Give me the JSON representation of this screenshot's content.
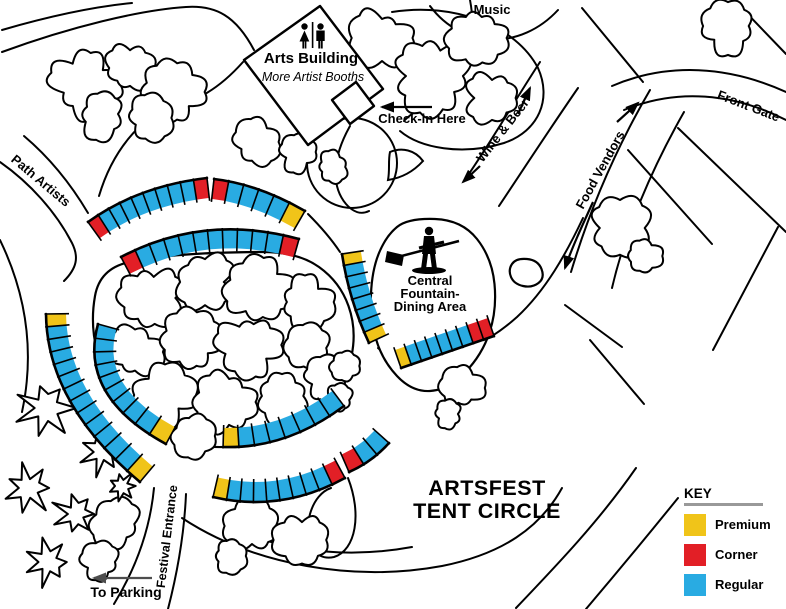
{
  "title": {
    "line1": "ARTSFEST",
    "line2": "TENT CIRCLE"
  },
  "key": {
    "heading": "KEY",
    "items": [
      {
        "label": "Premium",
        "type": "premium",
        "color": "#F0C419"
      },
      {
        "label": "Corner",
        "type": "corner",
        "color": "#E21F26"
      },
      {
        "label": "Regular",
        "type": "regular",
        "color": "#29ABE2"
      }
    ]
  },
  "palette": {
    "ink": "#000000",
    "gray_arrow": "#4d4d4d",
    "key_underline": "#999999",
    "premium": "#F0C419",
    "corner": "#E21F26",
    "regular": "#29ABE2"
  },
  "labels": [
    {
      "id": "music",
      "text": "Music",
      "x": 492,
      "y": 14,
      "rot": 0,
      "size": 13
    },
    {
      "id": "arts-building",
      "text": "Arts Building",
      "x": 311,
      "y": 63,
      "rot": 0,
      "size": 15
    },
    {
      "id": "arts-building-sub",
      "text": "More Artist Booths",
      "x": 313,
      "y": 81,
      "rot": 0,
      "size": 12.5,
      "italic": true,
      "weight": "normal"
    },
    {
      "id": "checkin",
      "text": "Check-in Here",
      "x": 422,
      "y": 123,
      "rot": 0,
      "size": 13
    },
    {
      "id": "wine-beer",
      "text": "Wine & Beer",
      "x": 506,
      "y": 133,
      "rot": -52,
      "size": 13
    },
    {
      "id": "food-vendors",
      "text": "Food Vendors",
      "x": 604,
      "y": 172,
      "rot": -61,
      "size": 13
    },
    {
      "id": "front-gate",
      "text": "Front Gate",
      "x": 747,
      "y": 110,
      "rot": 21,
      "size": 13
    },
    {
      "id": "path-artists",
      "text": "Path Artists",
      "x": 38,
      "y": 184,
      "rot": 40,
      "size": 13
    },
    {
      "id": "fountain-line1",
      "text": "Central",
      "x": 430,
      "y": 285,
      "rot": 0,
      "size": 13
    },
    {
      "id": "fountain-line2",
      "text": "Fountain-",
      "x": 430,
      "y": 298,
      "rot": 0,
      "size": 13
    },
    {
      "id": "fountain-line3",
      "text": "Dining Area",
      "x": 430,
      "y": 311,
      "rot": 0,
      "size": 13
    },
    {
      "id": "festival-entrance",
      "text": "Festival Entrance",
      "x": 171,
      "y": 537,
      "rot": -83,
      "size": 12.5
    },
    {
      "id": "to-parking",
      "text": "To Parking",
      "x": 126,
      "y": 597,
      "rot": 0,
      "size": 14
    }
  ],
  "map_data": {
    "tent_color_codes": {
      "Y": "premium",
      "R": "corner",
      "B": "regular"
    },
    "tent_segments": [
      {
        "name": "outer-top-left",
        "p0": [
          88,
          222
        ],
        "p1": [
          138,
          186
        ],
        "p2": [
          207,
          178
        ],
        "width": 20,
        "side": 1,
        "colors": [
          "R",
          "B",
          "B",
          "B",
          "B",
          "B",
          "B",
          "B",
          "B",
          "R"
        ]
      },
      {
        "name": "outer-top-right",
        "p0": [
          214,
          179
        ],
        "p1": [
          258,
          184
        ],
        "p2": [
          305,
          211
        ],
        "width": 20,
        "side": 1,
        "colors": [
          "R",
          "B",
          "B",
          "B",
          "B",
          "Y"
        ]
      },
      {
        "name": "inner-top",
        "p0": [
          121,
          257
        ],
        "p1": [
          205,
          213
        ],
        "p2": [
          299,
          239
        ],
        "width": 19,
        "side": 1,
        "colors": [
          "R",
          "B",
          "B",
          "B",
          "B",
          "B",
          "B",
          "B",
          "B",
          "B",
          "B",
          "R"
        ]
      },
      {
        "name": "east-strip",
        "p0": [
          342,
          254
        ],
        "p1": [
          349,
          300
        ],
        "p2": [
          369,
          343
        ],
        "width": 19,
        "side": -1,
        "colors": [
          "Y",
          "B",
          "B",
          "B",
          "B",
          "B",
          "B",
          "Y"
        ]
      },
      {
        "name": "fountain-south",
        "p0": [
          401,
          368
        ],
        "p1": [
          447,
          352
        ],
        "p2": [
          494,
          336
        ],
        "width": 19,
        "side": -1,
        "colors": [
          "Y",
          "B",
          "B",
          "B",
          "B",
          "B",
          "B",
          "R",
          "R"
        ]
      },
      {
        "name": "outer-left",
        "p0": [
          46,
          314
        ],
        "p1": [
          47,
          404
        ],
        "p2": [
          140,
          482
        ],
        "width": 20,
        "side": -1,
        "colors": [
          "Y",
          "B",
          "B",
          "B",
          "B",
          "B",
          "B",
          "B",
          "B",
          "B",
          "B",
          "B",
          "B",
          "Y"
        ]
      },
      {
        "name": "inner-left",
        "p0": [
          98,
          324
        ],
        "p1": [
          78,
          396
        ],
        "p2": [
          166,
          444
        ],
        "width": 19,
        "side": -1,
        "colors": [
          "B",
          "B",
          "B",
          "B",
          "B",
          "B",
          "B",
          "B",
          "B",
          "Y"
        ]
      },
      {
        "name": "inner-bottom",
        "p0": [
          223,
          447
        ],
        "p1": [
          287,
          449
        ],
        "p2": [
          344,
          406
        ],
        "width": 19,
        "side": -1,
        "colors": [
          "Y",
          "B",
          "B",
          "B",
          "B",
          "B",
          "B",
          "B"
        ]
      },
      {
        "name": "outer-bottom",
        "p0": [
          213,
          497
        ],
        "p1": [
          281,
          513
        ],
        "p2": [
          345,
          478
        ],
        "width": 20,
        "side": -1,
        "colors": [
          "Y",
          "B",
          "B",
          "B",
          "B",
          "B",
          "B",
          "B",
          "B",
          "R"
        ]
      },
      {
        "name": "outer-southeast",
        "p0": [
          349,
          472
        ],
        "p1": [
          372,
          462
        ],
        "p2": [
          389,
          443
        ],
        "width": 19,
        "side": -1,
        "colors": [
          "R",
          "B",
          "B"
        ]
      }
    ],
    "roads": [
      {
        "name": "road-top-left-upper",
        "d": "M 2,30 C 50,16 92,7 132,3"
      },
      {
        "name": "road-top-left-lower",
        "d": "M 2,52 C 70,27 140,10 186,7 C 216,5 236,16 254,50"
      },
      {
        "name": "road-path-artists-left",
        "d": "M 0,162 C 30,183 56,212 72,243 C 79,257 77,268 64,281"
      },
      {
        "name": "road-path-artists-right",
        "d": "M 24,136 C 50,158 72,186 88,213"
      },
      {
        "name": "road-building-southwest",
        "d": "M 243,62 C 218,90 196,101 172,107 C 140,117 112,152 99,196"
      },
      {
        "name": "road-checkin-south",
        "d": "M 350,126 C 332,158 331,186 346,204 C 353,212 361,215 369,211"
      },
      {
        "name": "road-northeast-loop",
        "d": "M 392,12 C 455,2 516,26 538,68 C 552,99 539,131 504,143 C 462,156 420,148 400,131"
      },
      {
        "name": "road-building-east",
        "d": "M 470,0 C 478,42 465,78 437,98 C 426,106 412,112 404,121"
      },
      {
        "name": "road-island",
        "d": "M 390,152 C 402,147 415,150 423,161 C 413,172 401,178 388,180 C 390,170 388,161 390,152 Z"
      },
      {
        "name": "road-west-bush-loop",
        "d": "M 397,163 A 45 45 0 1 0 307,163 A 45 45 0 1 0 397,163"
      },
      {
        "name": "road-music-arc",
        "d": "M 430,6 C 463,50 521,50 558,10"
      },
      {
        "name": "road-wine-beer-left",
        "d": "M 540,62 C 512,105 488,147 464,181"
      },
      {
        "name": "road-wine-beer-right",
        "d": "M 578,88 C 549,130 523,170 499,206"
      },
      {
        "name": "road-food-vendors-left",
        "d": "M 650,90 C 615,150 589,212 571,272"
      },
      {
        "name": "road-food-vendors-right",
        "d": "M 684,112 C 651,170 625,232 612,288"
      },
      {
        "name": "road-food-curve-south",
        "d": "M 583,218 C 566,254 546,290 517,317 C 508,325 500,331 492,336"
      },
      {
        "name": "road-front-gate-upper",
        "d": "M 612,86 C 668,62 729,66 786,92"
      },
      {
        "name": "road-front-gate-lower",
        "d": "M 624,110 C 677,88 733,93 786,120"
      },
      {
        "name": "road-ring-northeast",
        "d": "M 308,214 C 322,228 332,240 340,252"
      },
      {
        "name": "road-ring-east",
        "d": "M 378,348 C 388,357 395,362 400,367"
      },
      {
        "name": "road-diagonal-1",
        "d": "M 582,8 L 643,82"
      },
      {
        "name": "road-diagonal-2",
        "d": "M 628,150 L 712,244"
      },
      {
        "name": "road-diagonal-3",
        "d": "M 678,128 L 786,232"
      },
      {
        "name": "road-diagonal-4",
        "d": "M 778,227 L 713,350"
      },
      {
        "name": "road-diagonal-5",
        "d": "M 590,340 L 644,404"
      },
      {
        "name": "road-diagonal-6",
        "d": "M 736,2 L 786,54"
      },
      {
        "name": "road-diagonal-7",
        "d": "M 565,305 L 622,347"
      },
      {
        "name": "road-southeast-upper",
        "d": "M 636,468 C 600,520 558,564 516,608"
      },
      {
        "name": "road-southeast-lower",
        "d": "M 678,498 C 644,540 614,576 586,609"
      },
      {
        "name": "road-bottom-outer",
        "d": "M 182,518 C 255,566 355,582 442,566 C 502,554 540,528 562,488"
      },
      {
        "name": "road-bottom-inner",
        "d": "M 230,528 C 290,553 352,558 412,547"
      },
      {
        "name": "road-festival-left",
        "d": "M 154,488 C 150,530 136,568 114,604"
      },
      {
        "name": "road-festival-right",
        "d": "M 186,494 C 184,540 176,578 168,609"
      },
      {
        "name": "road-left-edge",
        "d": "M 0,240 C 28,298 34,356 22,412"
      },
      {
        "name": "road-se-loop",
        "d": "M 348,478 C 362,514 356,550 334,557 C 313,562 303,538 310,514 C 314,500 322,491 331,488"
      }
    ],
    "white_areas": [
      {
        "name": "central-lawn",
        "points": [
          [
            100,
            268
          ],
          [
            160,
            256
          ],
          [
            228,
            252
          ],
          [
            298,
            252
          ],
          [
            340,
            282
          ],
          [
            357,
            330
          ],
          [
            346,
            382
          ],
          [
            310,
            422
          ],
          [
            254,
            446
          ],
          [
            194,
            448
          ],
          [
            140,
            424
          ],
          [
            104,
            378
          ],
          [
            90,
            324
          ]
        ]
      },
      {
        "name": "fountain-dining-area",
        "points": [
          [
            408,
            218
          ],
          [
            462,
            220
          ],
          [
            492,
            258
          ],
          [
            497,
            310
          ],
          [
            482,
            355
          ],
          [
            448,
            390
          ],
          [
            412,
            392
          ],
          [
            382,
            360
          ],
          [
            370,
            318
          ],
          [
            372,
            270
          ],
          [
            386,
            236
          ]
        ]
      },
      {
        "name": "small-pond",
        "points": [
          [
            516,
            258
          ],
          [
            538,
            260
          ],
          [
            545,
            278
          ],
          [
            532,
            288
          ],
          [
            514,
            284
          ],
          [
            508,
            270
          ]
        ]
      }
    ],
    "bushes": [
      [
        85,
        85,
        30
      ],
      [
        130,
        68,
        24
      ],
      [
        172,
        92,
        28
      ],
      [
        102,
        114,
        22
      ],
      [
        150,
        118,
        20
      ],
      [
        382,
        38,
        26
      ],
      [
        432,
        76,
        32
      ],
      [
        478,
        38,
        28
      ],
      [
        492,
        98,
        24
      ],
      [
        256,
        142,
        20
      ],
      [
        298,
        152,
        18
      ],
      [
        332,
        167,
        15
      ],
      [
        150,
        298,
        28
      ],
      [
        205,
        282,
        26
      ],
      [
        258,
        290,
        30
      ],
      [
        305,
        302,
        24
      ],
      [
        135,
        352,
        24
      ],
      [
        192,
        340,
        28
      ],
      [
        250,
        345,
        28
      ],
      [
        308,
        348,
        22
      ],
      [
        165,
        395,
        26
      ],
      [
        225,
        402,
        28
      ],
      [
        282,
        396,
        24
      ],
      [
        325,
        378,
        18
      ],
      [
        620,
        228,
        26
      ],
      [
        643,
        256,
        18
      ],
      [
        728,
        26,
        24
      ],
      [
        193,
        436,
        18
      ],
      [
        345,
        366,
        14
      ],
      [
        338,
        400,
        13
      ],
      [
        462,
        388,
        19
      ],
      [
        448,
        414,
        12
      ],
      [
        252,
        526,
        25
      ],
      [
        302,
        540,
        24
      ],
      [
        230,
        556,
        15
      ],
      [
        116,
        524,
        22
      ],
      [
        100,
        562,
        17
      ]
    ],
    "pines": [
      [
        45,
        408,
        27
      ],
      [
        102,
        452,
        22
      ],
      [
        28,
        488,
        25
      ],
      [
        76,
        514,
        22
      ],
      [
        48,
        562,
        23
      ],
      [
        122,
        486,
        15
      ]
    ],
    "building": {
      "outline": [
        [
          320,
          6
        ],
        [
          383,
          89
        ],
        [
          308,
          145
        ],
        [
          244,
          60
        ]
      ],
      "checkin_square": [
        [
          332,
          100
        ],
        [
          350,
          124
        ],
        [
          374,
          106
        ],
        [
          356,
          82
        ]
      ]
    },
    "arrows": [
      {
        "name": "checkin-arrow",
        "d": "M 432,107 L 382,107",
        "color": "ink"
      },
      {
        "name": "wine-beer-arrow-up",
        "d": "M 518,114 L 530,88",
        "color": "ink"
      },
      {
        "name": "wine-beer-arrow-down",
        "d": "M 480,166 L 463,182",
        "color": "ink"
      },
      {
        "name": "food-vendors-arrow-down",
        "d": "M 593,202 C 582,226 571,250 565,268",
        "color": "ink"
      },
      {
        "name": "food-vendors-arrow-up",
        "d": "M 617,122 L 638,103",
        "color": "ink"
      },
      {
        "name": "to-parking-arrow",
        "d": "M 152,578 L 94,578",
        "color": "gray"
      }
    ]
  }
}
